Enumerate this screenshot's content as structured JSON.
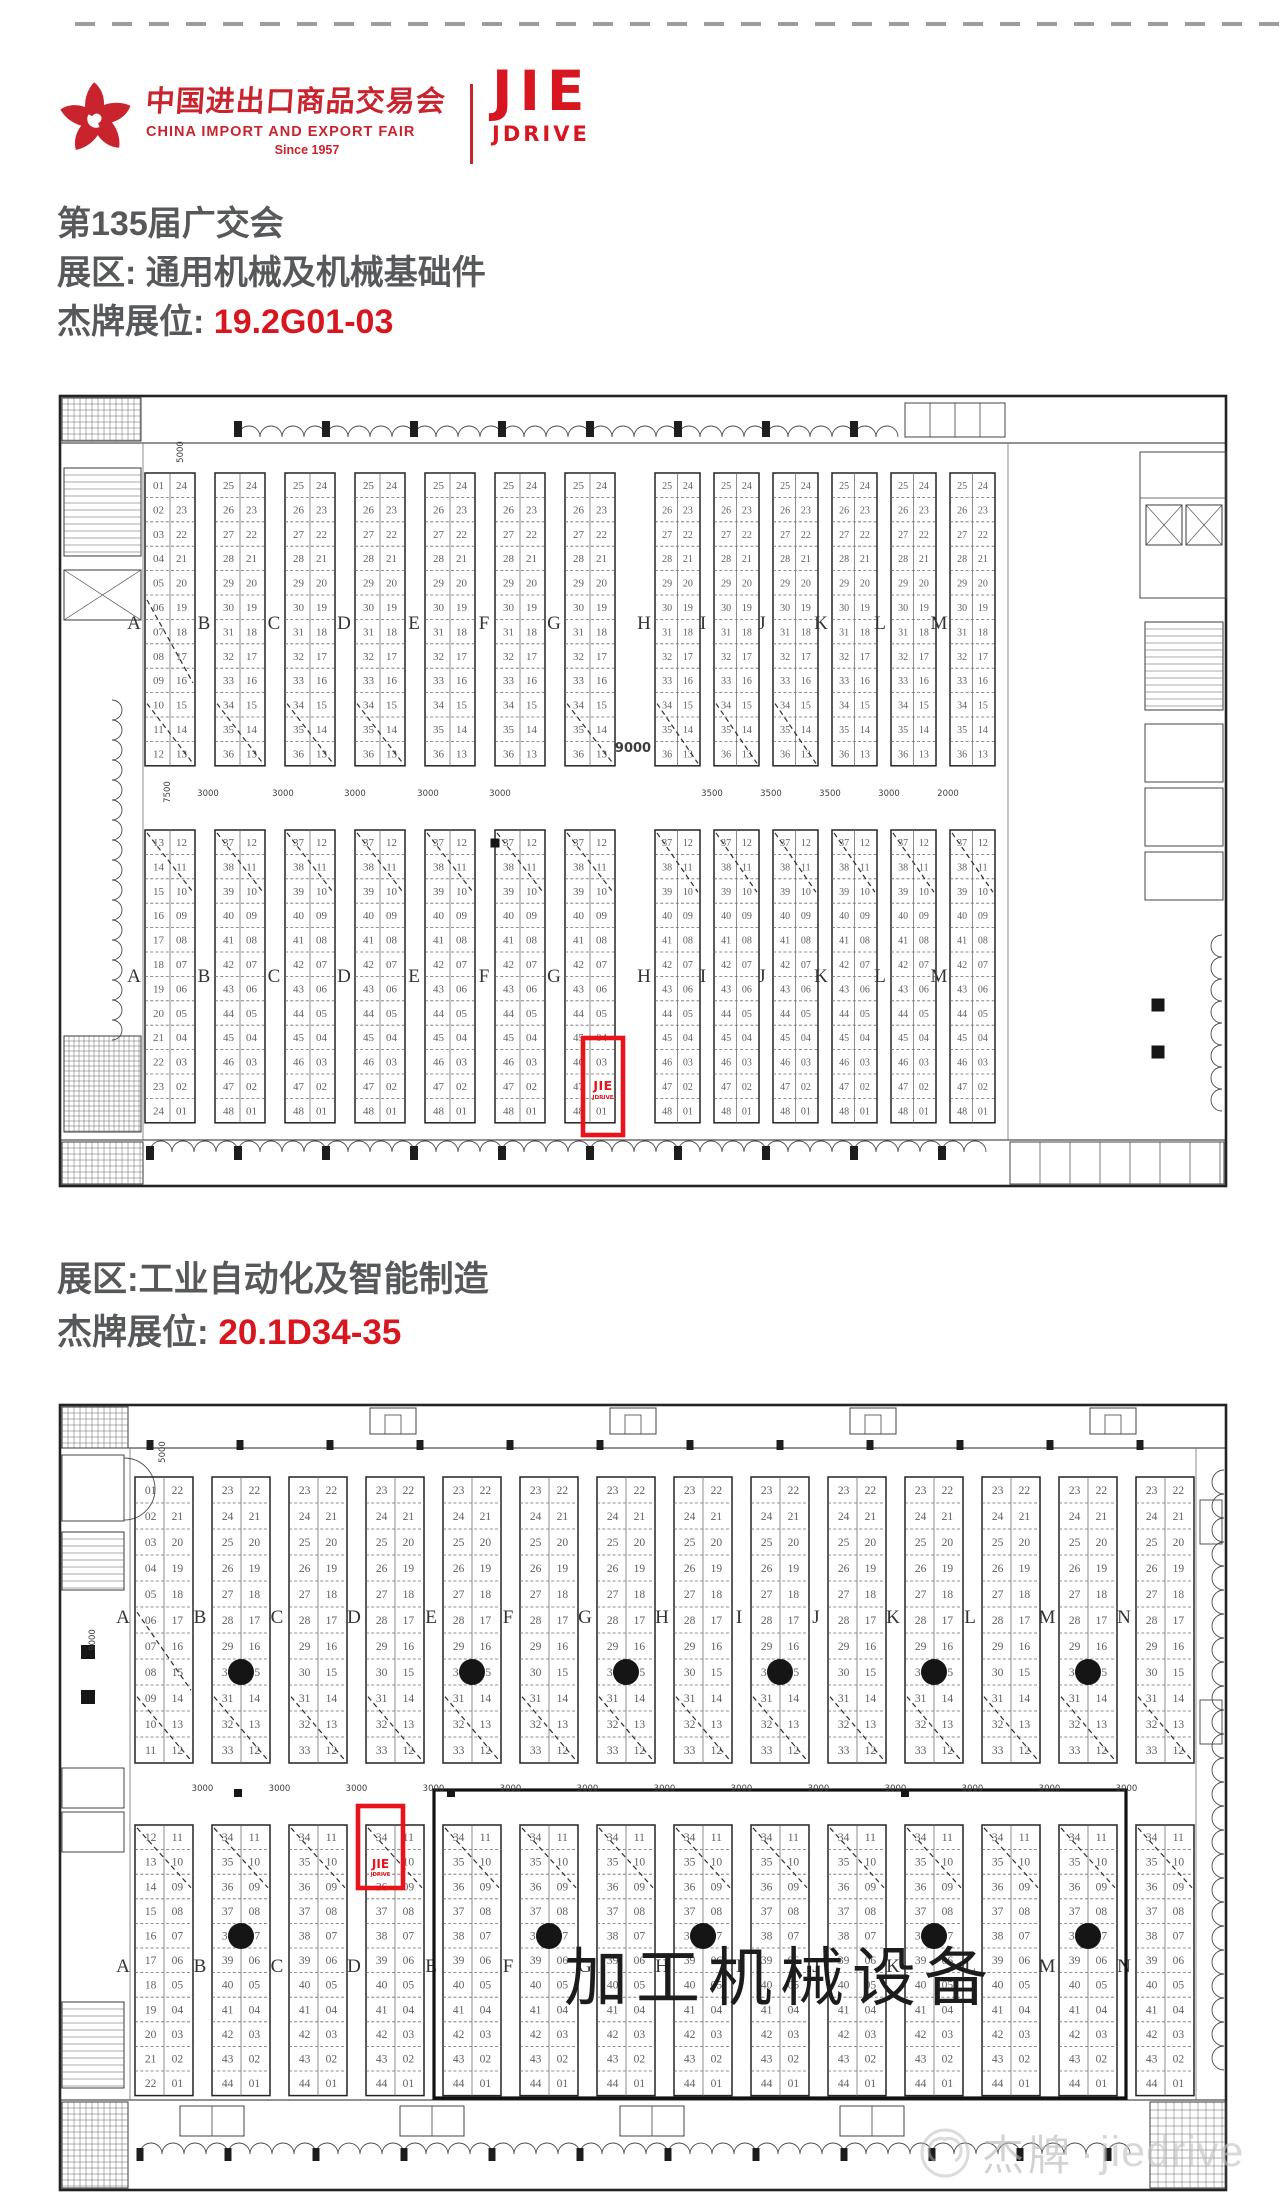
{
  "page": {
    "accent": "#d8161f",
    "marker_red": "#e8131b",
    "text_gray": "#57585a",
    "plan_dark": "#232323",
    "plan_mid": "#6f6f6f",
    "plan_num": "#5f5f5f",
    "watermark_gray": "#bdbcbc"
  },
  "header": {
    "fair_logo_cn": "中国进出口商品交易会",
    "fair_logo_en": "CHINA IMPORT AND EXPORT FAIR",
    "fair_logo_since": "Since 1957",
    "brand_line1": "JIE",
    "brand_line2": "JDRIVE"
  },
  "section1": {
    "title": "第135届广交会",
    "zone_label": "展区:",
    "zone_value": "通用机械及机械基础件",
    "booth_label": "杰牌展位:",
    "booth_value": "19.2G01-03"
  },
  "section2": {
    "zone_label": "展区:",
    "zone_value": "工业自动化及智能制造",
    "booth_label": "杰牌展位:",
    "booth_value": "20.1D34-35"
  },
  "plan1": {
    "letters": [
      "A",
      "B",
      "C",
      "D",
      "E",
      "F",
      "G",
      "H",
      "I",
      "J",
      "K",
      "L",
      "M"
    ],
    "columns": {
      "A": {
        "topL": [
          1,
          12
        ],
        "topR": [
          24,
          13
        ],
        "botL": [
          13,
          24
        ],
        "botR": [
          12,
          1
        ]
      },
      "default": {
        "topL": [
          25,
          36
        ],
        "topR": [
          24,
          13
        ],
        "botL": [
          37,
          48
        ],
        "botR": [
          12,
          1
        ]
      }
    },
    "aisle_dims": [
      {
        "x": 208,
        "t": "3000"
      },
      {
        "x": 283,
        "t": "3000"
      },
      {
        "x": 355,
        "t": "3000"
      },
      {
        "x": 428,
        "t": "3000"
      },
      {
        "x": 500,
        "t": "3000"
      },
      {
        "x": 633,
        "t": "9000",
        "big": true
      },
      {
        "x": 712,
        "t": "3500"
      },
      {
        "x": 771,
        "t": "3500"
      },
      {
        "x": 830,
        "t": "3500"
      },
      {
        "x": 889,
        "t": "3000"
      },
      {
        "x": 948,
        "t": "2000"
      }
    ],
    "v_dims": [
      {
        "x": 170,
        "y": 792,
        "t": "7500"
      },
      {
        "x": 183,
        "y": 452,
        "t": "5000"
      }
    ],
    "squares": [
      {
        "x": 495,
        "y": 843
      }
    ],
    "marker": {
      "column": "G",
      "above": "03",
      "below": "01",
      "logo1": "JIE",
      "logo2": "JDRIVE",
      "booths": "G01-03"
    }
  },
  "plan2": {
    "letters": [
      "A",
      "B",
      "C",
      "D",
      "E",
      "F",
      "G",
      "H",
      "I",
      "J",
      "K",
      "L",
      "M",
      "N"
    ],
    "columns": {
      "A": {
        "topL": [
          1,
          11
        ],
        "topR": [
          22,
          12
        ],
        "botL": [
          12,
          22
        ],
        "botR": [
          11,
          1
        ]
      },
      "default": {
        "topL": [
          23,
          33
        ],
        "topR": [
          22,
          12
        ],
        "botL": [
          34,
          44
        ],
        "botR": [
          11,
          1
        ]
      }
    },
    "aisle_dim_text": "3000",
    "v_dims": [
      {
        "x": 165,
        "y": 1452,
        "t": "5000"
      },
      {
        "x": 95,
        "y": 1640,
        "t": "9000"
      }
    ],
    "squares": [
      {
        "x": 238,
        "y": 1793
      },
      {
        "x": 451,
        "y": 1793
      },
      {
        "x": 905,
        "y": 1793
      }
    ],
    "big_label": "加工机械设备",
    "marker": {
      "column": "D",
      "above": "34",
      "logo1": "JIE",
      "logo2": "JDRIVE",
      "booths": "D34-35"
    }
  },
  "watermark": {
    "cn": "杰牌",
    "dot": "·",
    "en": "jiedrive"
  }
}
